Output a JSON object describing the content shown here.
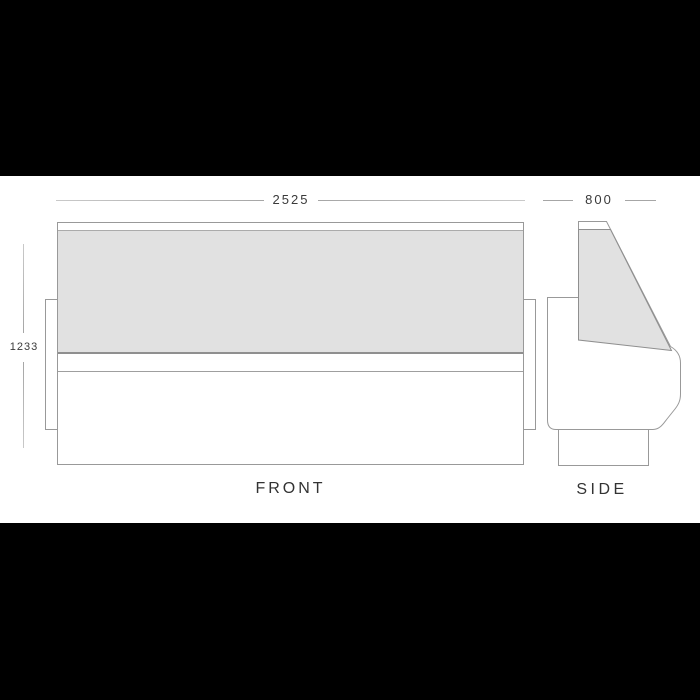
{
  "diagram": {
    "front_view": {
      "label": "FRONT",
      "width_mm": "2525",
      "height_mm": "1233"
    },
    "side_view": {
      "label": "SIDE",
      "depth_mm": "800"
    }
  },
  "colors": {
    "letterbox": "#000000",
    "canvas": "#ffffff",
    "glass_fill": "#e1e1e1",
    "outline": "#999999",
    "outline_dark": "#8f8f8f",
    "dim_line": "#a6a6a6",
    "dim_text": "#3a3a3a",
    "label_text": "#333333"
  }
}
